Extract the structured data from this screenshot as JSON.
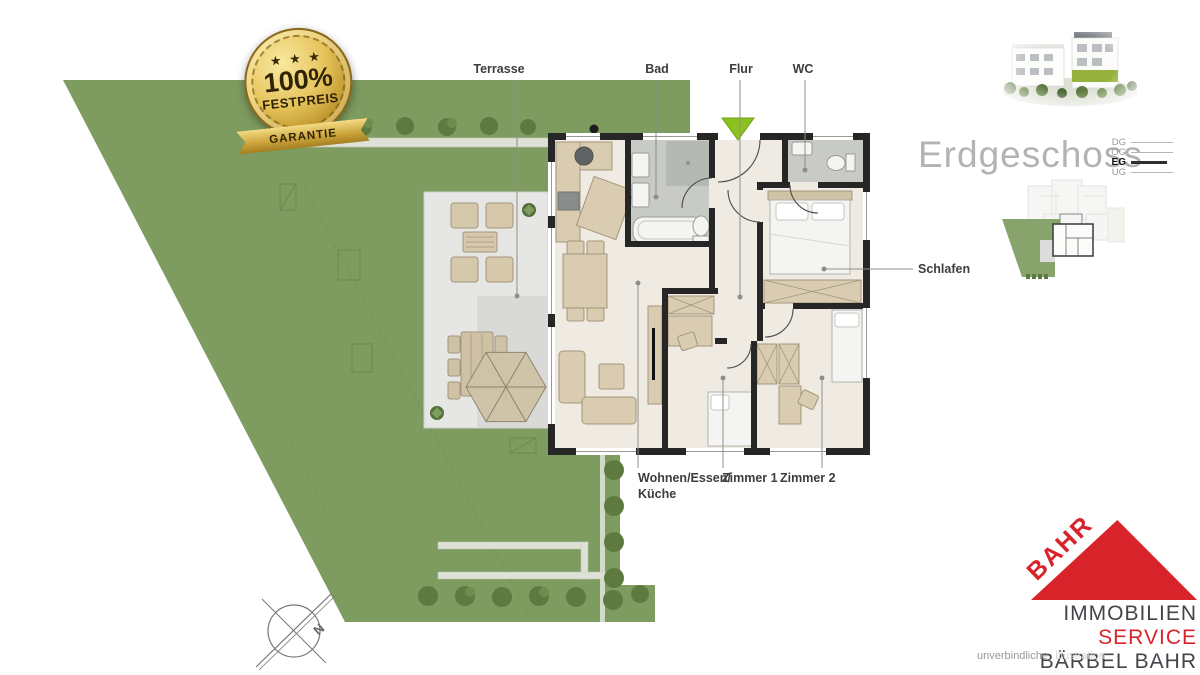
{
  "badge": {
    "stars": "★ ★ ★",
    "percent": "100%",
    "festpreis": "FESTPREIS",
    "garantie": "GARANTIE"
  },
  "header": {
    "floor_title": "Erdgeschoss"
  },
  "level_nav": [
    {
      "label": "DG",
      "active": false
    },
    {
      "label": "OG",
      "active": false
    },
    {
      "label": "EG",
      "active": true
    },
    {
      "label": "UG",
      "active": false
    }
  ],
  "labels": {
    "terrasse": "Terrasse",
    "bad": "Bad",
    "flur": "Flur",
    "wc": "WC",
    "schlafen": "Schlafen",
    "wohnen_line1": "Wohnen/Essen/",
    "wohnen_line2": "Küche",
    "zimmer1": "Zimmer 1",
    "zimmer2": "Zimmer 2"
  },
  "compass": {
    "north": "N"
  },
  "logo": {
    "brand": "BAHR",
    "line1": "IMMOBILIEN",
    "line2": "SERVICE",
    "line3": "BÄRBEL BAHR"
  },
  "footer": {
    "disclaimer_word1": "unverbindliche",
    "disclaimer_word2": "Illustration"
  },
  "colors": {
    "garden_green": "#7e9c5f",
    "bush_green": "#5d7b40",
    "terrace_gray": "#e6e6e5",
    "floor_cream": "#efebe2",
    "tile_gray": "#c7cac5",
    "wall_dark": "#262626",
    "furniture_beige": "#d9ccb0",
    "accent_red": "#d8232a",
    "badge_gold": "#caa239",
    "entrance_marker": "#8cc21f"
  }
}
